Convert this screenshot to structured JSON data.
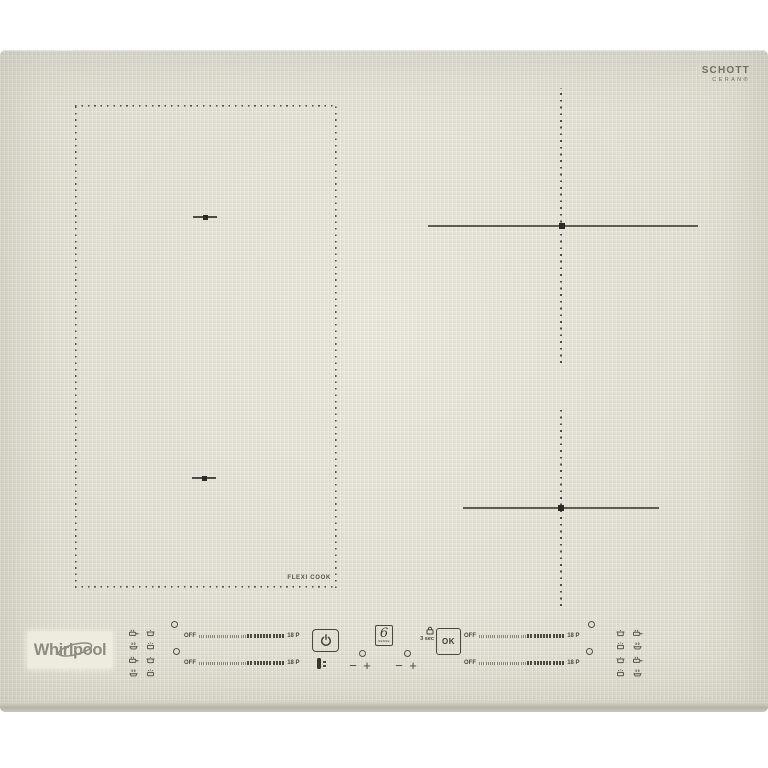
{
  "branding": {
    "whirlpool_logo": "Whirlpool",
    "glass_brand": {
      "line1": "SCHOTT",
      "line2": "CERAN®"
    }
  },
  "zones": {
    "flexi_label": "FLEXI COOK"
  },
  "control_panel": {
    "power_button": {
      "icon": "power-symbol"
    },
    "six_sense_logo": {
      "digit": "6",
      "sub_label": "SENSE"
    },
    "ok_button": {
      "label": "OK"
    },
    "lock_hint": {
      "label": "3 sec",
      "icon": "padlock"
    },
    "steppers": {
      "minus_label": "−",
      "plus_label": "+"
    },
    "sliders": [
      {
        "id": "left-rear",
        "off_label": "OFF",
        "max_label": "18 P"
      },
      {
        "id": "left-front",
        "off_label": "OFF",
        "max_label": "18 P"
      },
      {
        "id": "right-rear",
        "off_label": "OFF",
        "max_label": "18 P"
      },
      {
        "id": "right-front",
        "off_label": "OFF",
        "max_label": "18 P"
      }
    ],
    "cookware_icons": [
      "pan",
      "pot",
      "steam-pot",
      "boiling-pot"
    ]
  },
  "colors": {
    "surface": "#e3e1d3",
    "ink": "#4a4840",
    "logo_gray": "#8e8c82",
    "zone_line": "#5d5b52"
  }
}
